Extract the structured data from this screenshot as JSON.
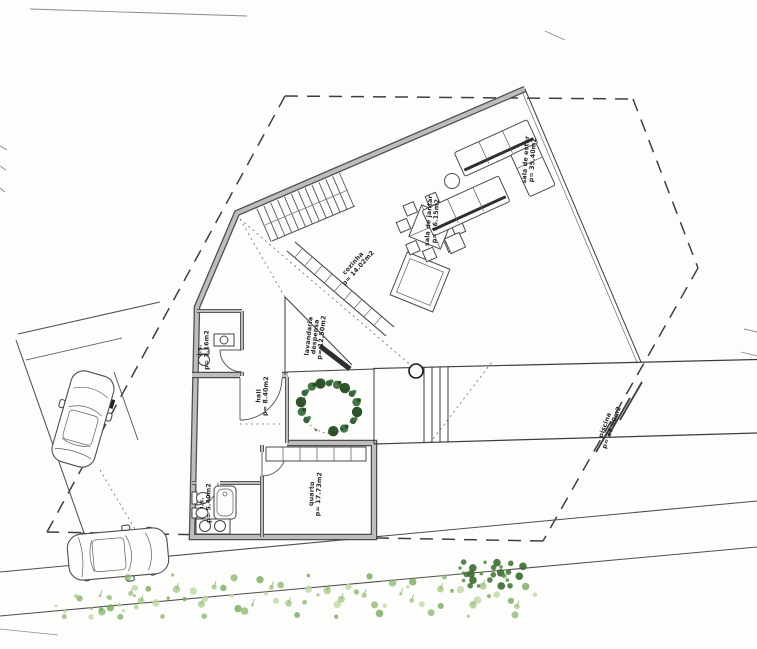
{
  "rooms": {
    "sala_estar": {
      "name": "sala de estar",
      "area": "p= 35.40m2"
    },
    "sala_jantar": {
      "name": "sala de jantar",
      "area": "p= 16.15m2"
    },
    "cozinha": {
      "name": "cozinha",
      "area": "p= 14.02m2"
    },
    "lavandaria": {
      "name": "lavandaria",
      "name2": "despensa",
      "area": "p= 12.50m2"
    },
    "is_piso": {
      "name": "i.s.",
      "area": "p= 3.16m2"
    },
    "hall": {
      "name": "hall",
      "area": "p= 8.40m2"
    },
    "quarto": {
      "name": "quarto",
      "area": "p= 17.73m2"
    },
    "is_quarto": {
      "name": "i.s.",
      "area": "p= 5.40m2"
    },
    "piscina": {
      "name": "piscina",
      "area": "p= 28.00m2"
    }
  },
  "colors": {
    "paper": "#fdfdfb",
    "wall_edge": "#4d4d4d",
    "wall_core": "#bdbdbd",
    "boundary": "#3f3f3f",
    "plant_dark": "#2e5b33",
    "plant_light": "#a6c98c"
  }
}
